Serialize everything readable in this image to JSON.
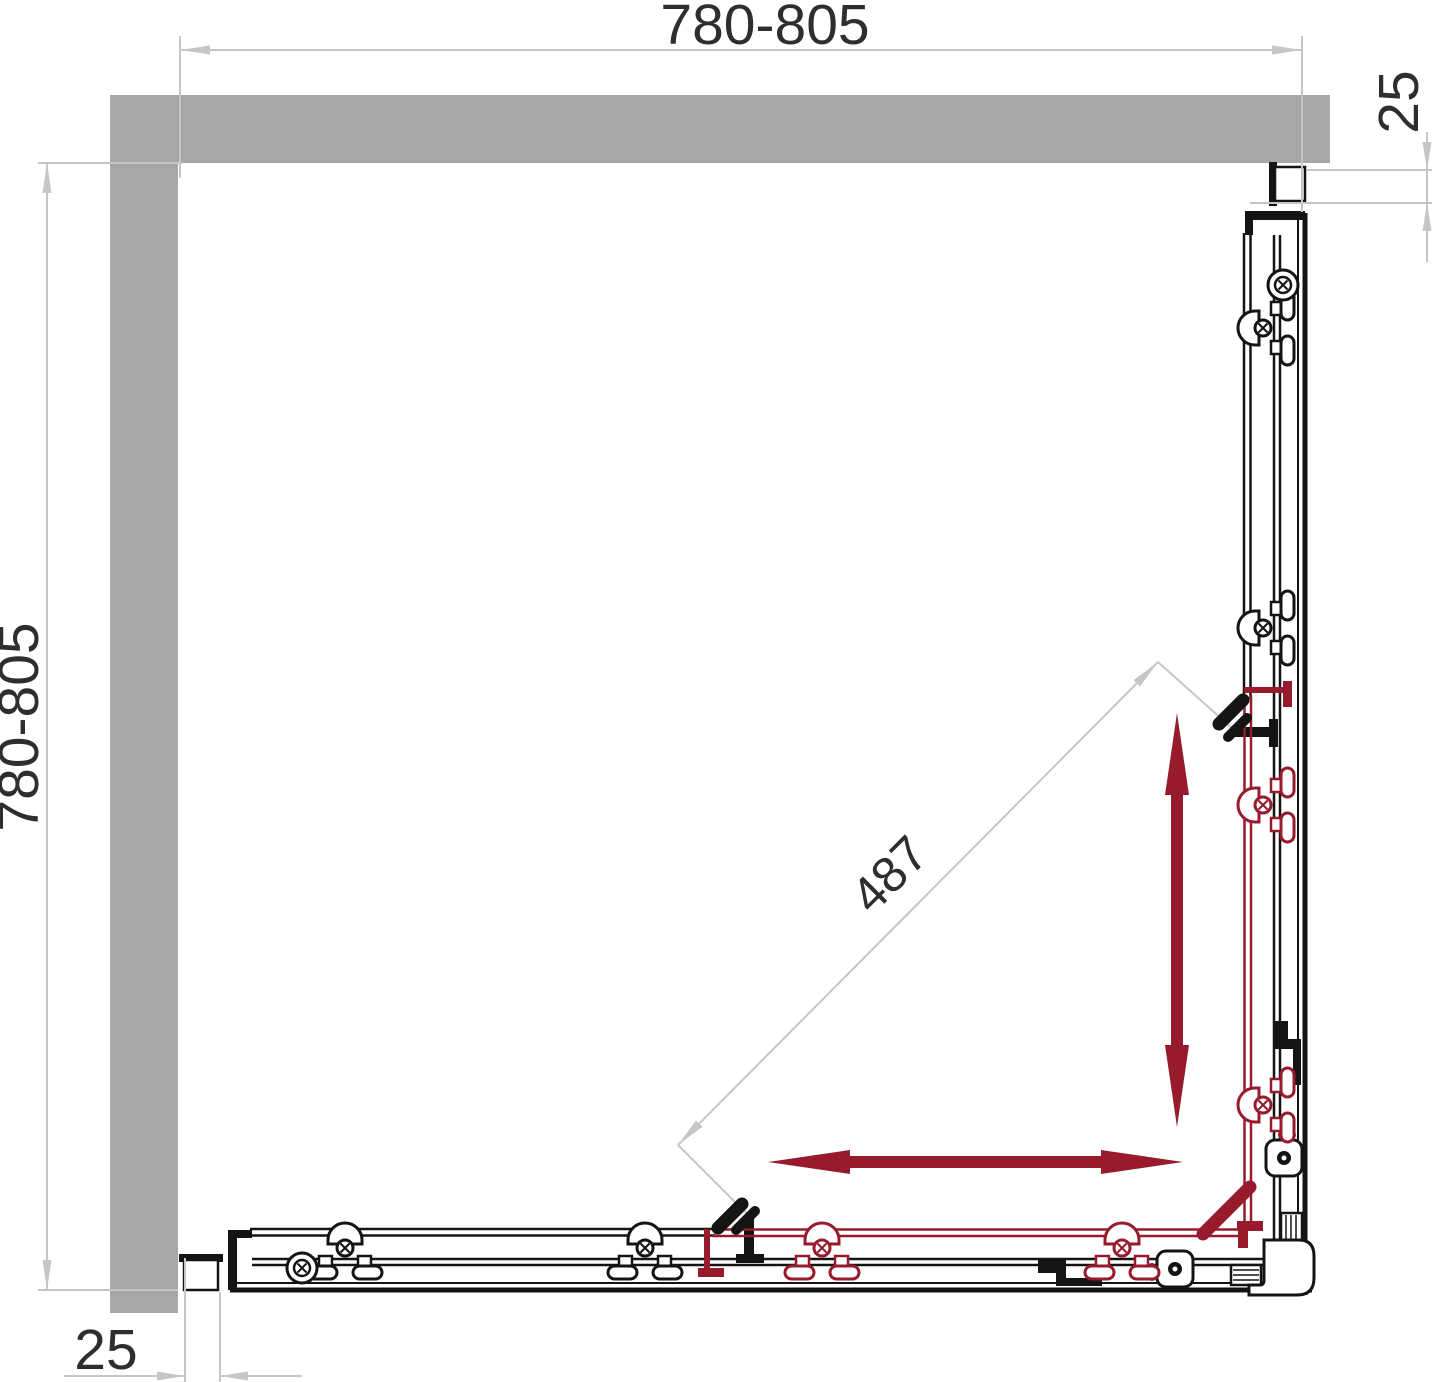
{
  "diagram": {
    "title": "shower-enclosure-plan-view",
    "dimensions": {
      "top_width": "780-805",
      "left_depth": "780-805",
      "right_wall_offset": "25",
      "bottom_wall_offset": "25",
      "diagonal_opening": "487"
    },
    "colors": {
      "background": "#ffffff",
      "wall": "#a7a7a7",
      "dimension_line": "#c6c6c6",
      "dimension_text": "#2e2e2e",
      "profile_black": "#141414",
      "sliding_door_red": "#971b2d"
    },
    "icons": [
      "door-slide-vertical-arrow",
      "door-slide-horizontal-arrow",
      "door-handle-knob"
    ]
  }
}
